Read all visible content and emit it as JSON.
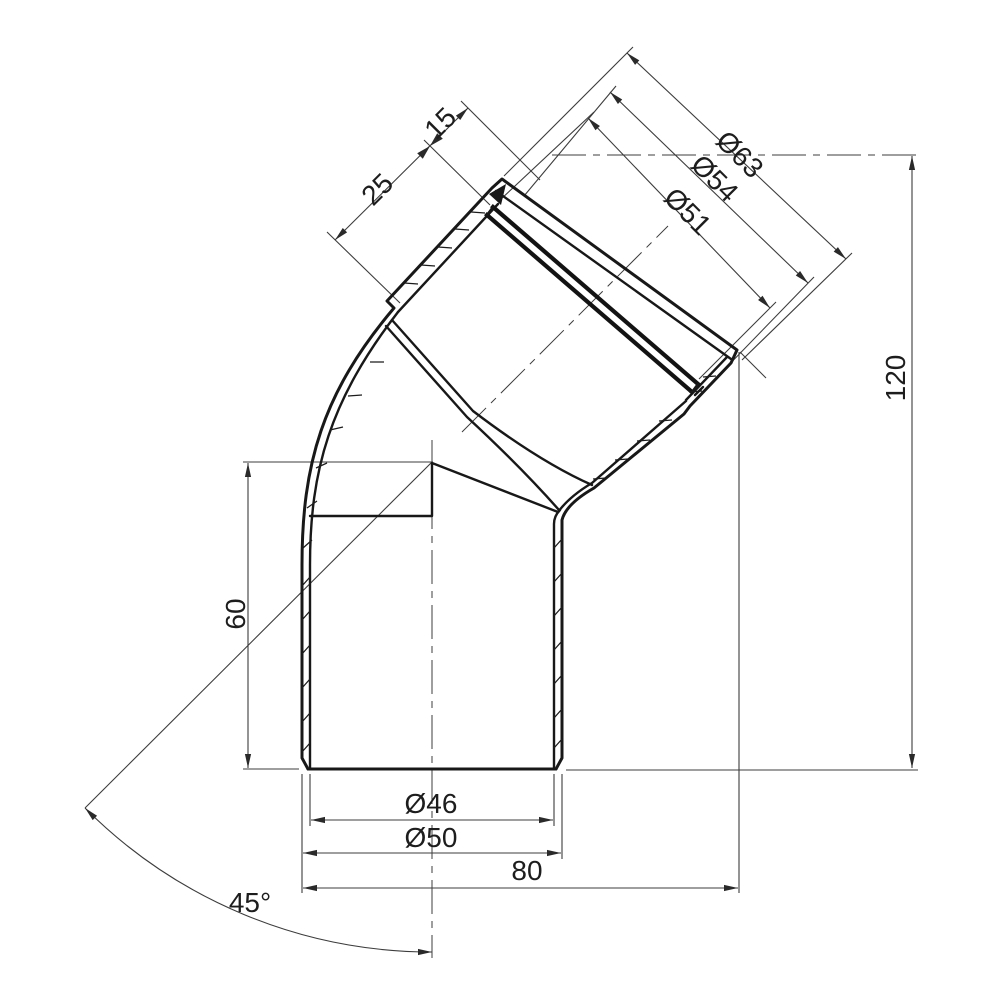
{
  "dims": {
    "socket_outer": "Ø63",
    "socket_bore": "Ø54",
    "ring_bore": "Ø51",
    "pipe_inner": "Ø46",
    "pipe_outer": "Ø50",
    "overall_width": "80",
    "overall_height": "120",
    "center_to_end": "60",
    "socket_depth": "25",
    "ring_zone": "15",
    "angle": "45°"
  }
}
